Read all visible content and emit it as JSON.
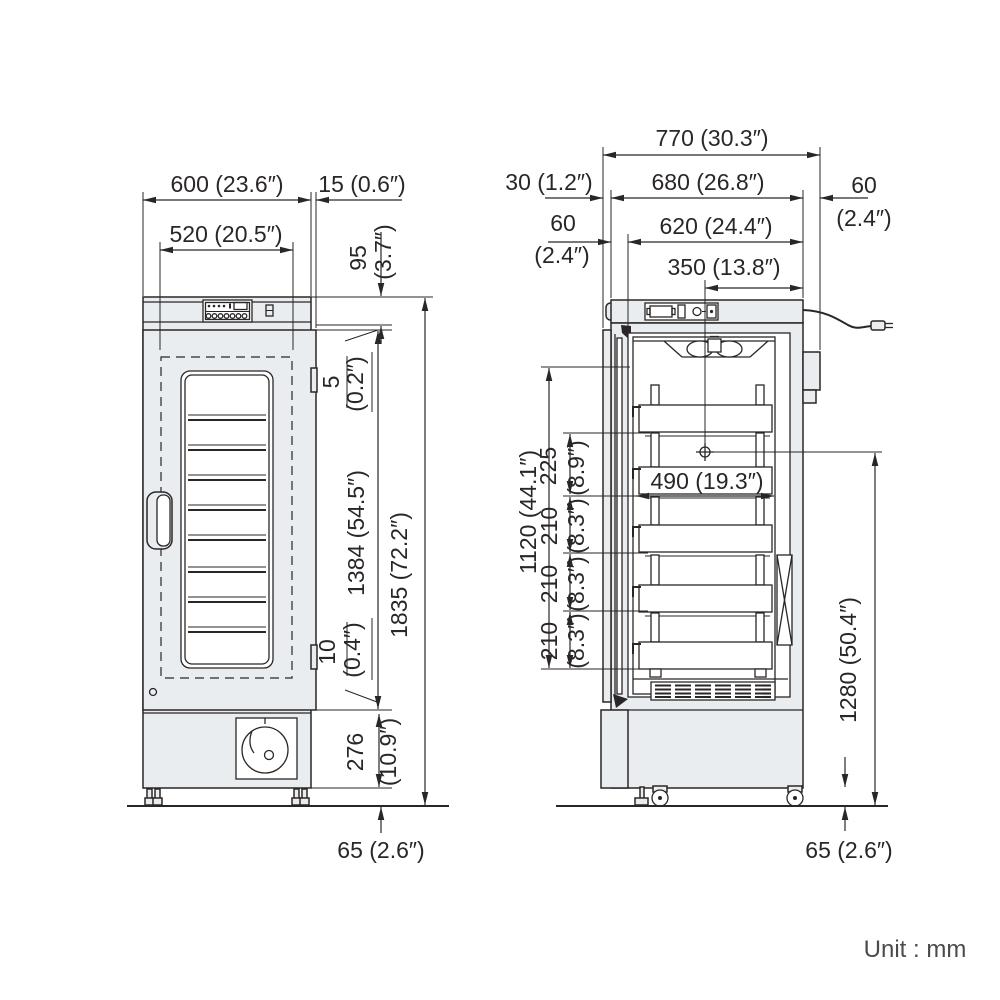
{
  "unit_note": "Unit : mm",
  "front_view": {
    "dim_overall_width": "600 (23.6″)",
    "dim_door_overhang": "15 (0.6″)",
    "dim_inner_width": "520 (20.5″)",
    "dim_top_panel_mm": "95",
    "dim_top_panel_in": "(3.7″)",
    "dim_top_gap_mm": "5",
    "dim_top_gap_in": "(0.2″)",
    "dim_door_height": "1384 (54.5″)",
    "dim_overall_height": "1835 (72.2″)",
    "dim_bottom_gap_mm": "10",
    "dim_bottom_gap_in": "(0.4″)",
    "dim_base_height_mm": "276",
    "dim_base_height_in": "(10.9″)",
    "dim_foot_height": "65 (2.6″)"
  },
  "side_view": {
    "dim_overall_depth": "770 (30.3″)",
    "dim_rear_clearance": "30 (1.2″)",
    "dim_body_depth": "680 (26.8″)",
    "dim_rear_offset_mm": "60",
    "dim_rear_offset_in": "(2.4″)",
    "dim_wall_mm": "60",
    "dim_wall_in": "(2.4″)",
    "dim_inner_depth": "620 (24.4″)",
    "dim_anchor_depth": "350 (13.8″)",
    "dim_basket_depth": "490 (19.3″)",
    "dim_inner_height": "1120 (44.1″)",
    "dim_pitch1_mm": "225",
    "dim_pitch1_in": "(8.9″)",
    "dim_pitch2_mm": "210",
    "dim_pitch2_in": "(8.3″)",
    "dim_pitch3_mm": "210",
    "dim_pitch3_in": "(8.3″)",
    "dim_pitch4_mm": "210",
    "dim_pitch4_in": "(8.3″)",
    "dim_anchor_height": "1280 (50.4″)",
    "dim_caster_height": "65 (2.6″)"
  }
}
